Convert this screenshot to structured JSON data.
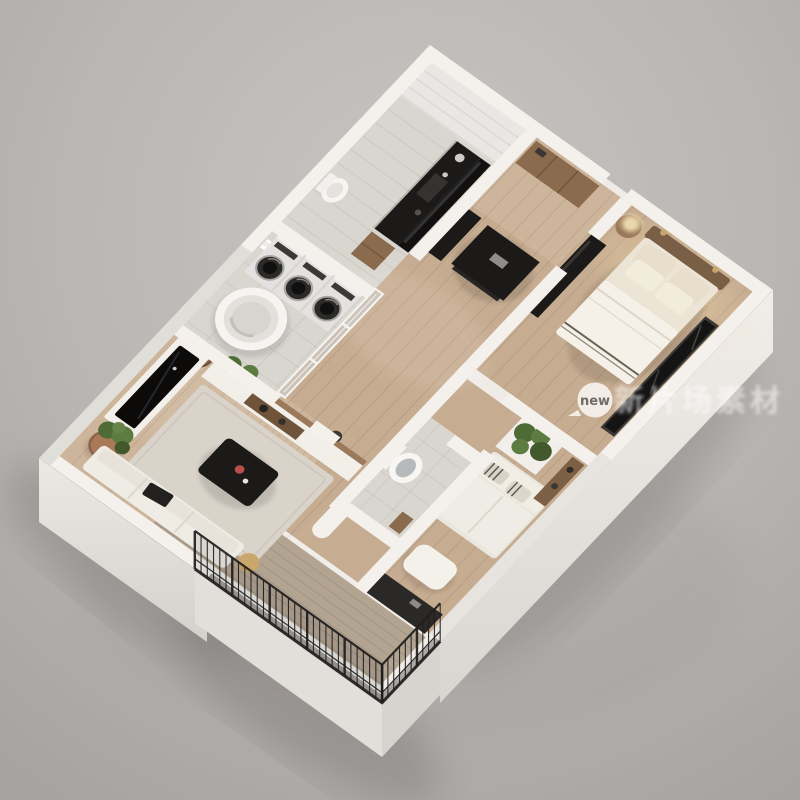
{
  "watermark": {
    "text": "新片场素材",
    "logo_text": "new",
    "text_color": "#ffffff",
    "text_opacity": 0.55,
    "logo_bg": "#ffffff",
    "logo_text_color": "#6f6b66"
  },
  "palette": {
    "background_center": "#c7c3c1",
    "background_edge": "#a9a5a3",
    "ground_shadow": "#7e7a77",
    "wall": "#f4f1ec",
    "wall_glow": "#ffffff",
    "wall_shadow_face": "#d9d5d1",
    "exterior_face_light": "#efebe7",
    "exterior_face_dark": "#d8d4d0",
    "wood_floor": "#c6ac90",
    "wood_floor_light": "#cdb59b",
    "tile_floor": "#d9d6d0",
    "white_floor": "#e9e7e3",
    "balcony_floor": "#b3a492",
    "dark_furniture": "#1b1a19",
    "dark_furniture_mid": "#2a2928",
    "wood_furniture": "#8a6b4e",
    "wood_shelf": "#9a7a5a",
    "bed_linen": "#ece4d4",
    "bed_blanket": "#f5f1e8",
    "bed_headboard": "#7a5f47",
    "pillow": "#e7decb",
    "sofa_white": "#efece5",
    "rug": "#d9d3ca",
    "plant_green": "#4e6b36",
    "plant_green_light": "#5d7c42",
    "terracotta": "#a9795a",
    "railing_black": "#1f1e1d",
    "glass_partition": "#cfd6d8",
    "water_gray": "#b7babb",
    "washer_body": "#e3e2e0",
    "washer_door": "#2b2a29",
    "red_accent": "#b94f48",
    "brass": "#c9a66b",
    "warm_light": "#f2ddb7"
  },
  "scene": {
    "type": "isometric-floor-plan-render",
    "description": "Photoreal 3D isometric cutaway floor plan of a small apartment on a gray studio background",
    "rooms": [
      {
        "name": "storage-nook",
        "furniture": []
      },
      {
        "name": "kitchen",
        "furniture": [
          "black-countertop",
          "sink",
          "mirror-backsplash",
          "wall-toilet",
          "wood-cabinet"
        ]
      },
      {
        "name": "entry-hall",
        "furniture": [
          "wardrobe"
        ]
      },
      {
        "name": "corridor",
        "furniture": [
          "refrigerator",
          "kitchen-island"
        ]
      },
      {
        "name": "laundry-bathroom",
        "furniture": [
          "washing-machine",
          "washing-machine",
          "washing-machine",
          "round-bathtub",
          "toilet-paper-holder",
          "glass-partition"
        ]
      },
      {
        "name": "bedroom",
        "furniture": [
          "double-bed",
          "headboard",
          "pillows",
          "nightstand",
          "table-lamp",
          "wall-sconces",
          "desk-console",
          "mirror-wardrobe"
        ]
      },
      {
        "name": "toilet-room",
        "furniture": [
          "toilet"
        ]
      },
      {
        "name": "lounge",
        "furniture": [
          "striped-pillow-sofa",
          "planter-box",
          "daybed-ottoman",
          "media-console",
          "wood-shelf"
        ]
      },
      {
        "name": "living-room",
        "furniture": [
          "tv-panel",
          "sideboard",
          "potted-plant",
          "rug",
          "coffee-table",
          "sofa",
          "side-table",
          "laptop"
        ]
      },
      {
        "name": "balcony",
        "furniture": [
          "metal-railing"
        ]
      }
    ]
  }
}
